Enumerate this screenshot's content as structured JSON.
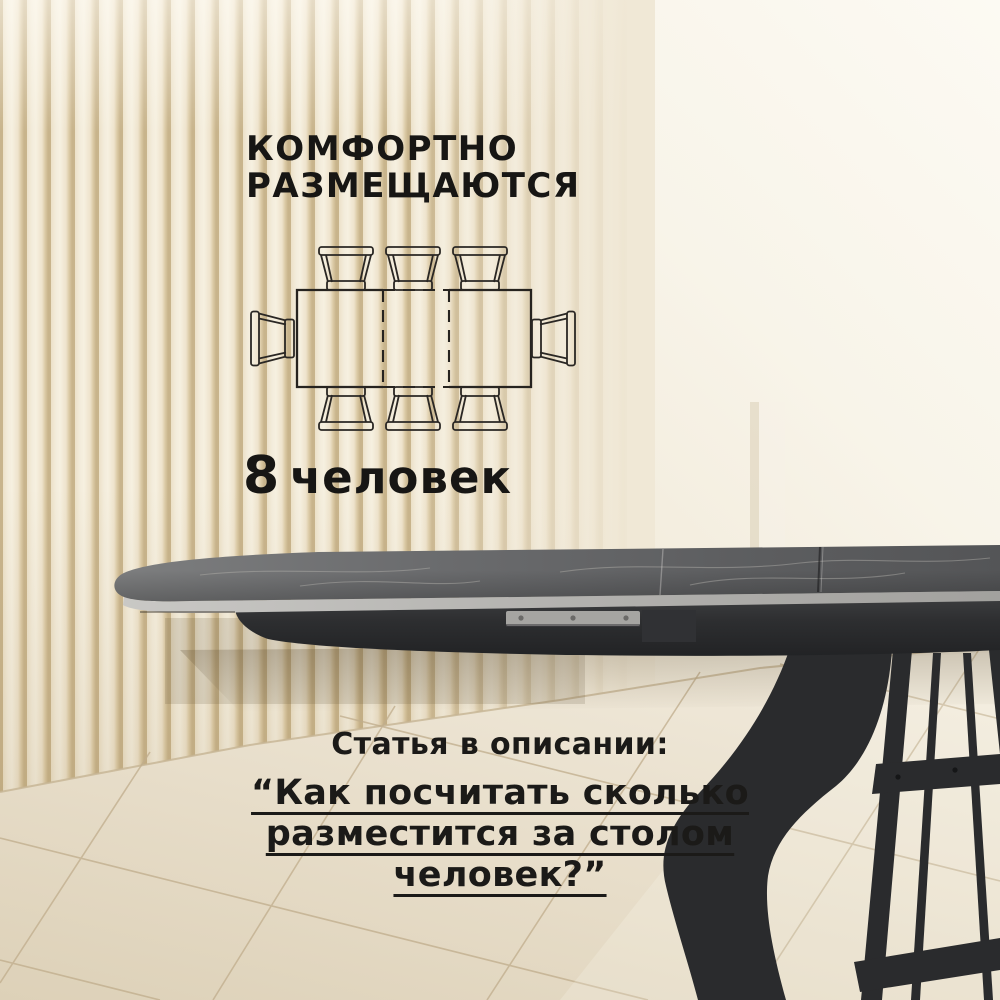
{
  "header": {
    "title_line1": "КОМФОРТНО",
    "title_line2": "РАЗМЕЩАЮТСЯ"
  },
  "capacity": {
    "value": "8",
    "label": "человек"
  },
  "seating_diagram": {
    "total_seats": 8,
    "seats_top": 3,
    "seats_bottom": 3,
    "seats_left": 1,
    "seats_right": 1,
    "table_type": "extendable-rectangular-table-top-view-with-dashed-leaf"
  },
  "article_note": {
    "intro": "Статья в описании:",
    "quote_lines": [
      "“Как посчитать сколько",
      "разместится за столом",
      "человек?”"
    ]
  },
  "colors": {
    "text": "#171614",
    "wall": "#efe7d5",
    "slat_shadow": "#c8b48c",
    "floor": "#e4d9c2",
    "grout": "#c0ad8c",
    "tabletop": "#636466",
    "tabletop_vein": "#b5b3ae",
    "table_edge_band": "#b5b4b1",
    "table_frame": "#2b2c2e",
    "extension_rail": "#a6a5a2"
  }
}
